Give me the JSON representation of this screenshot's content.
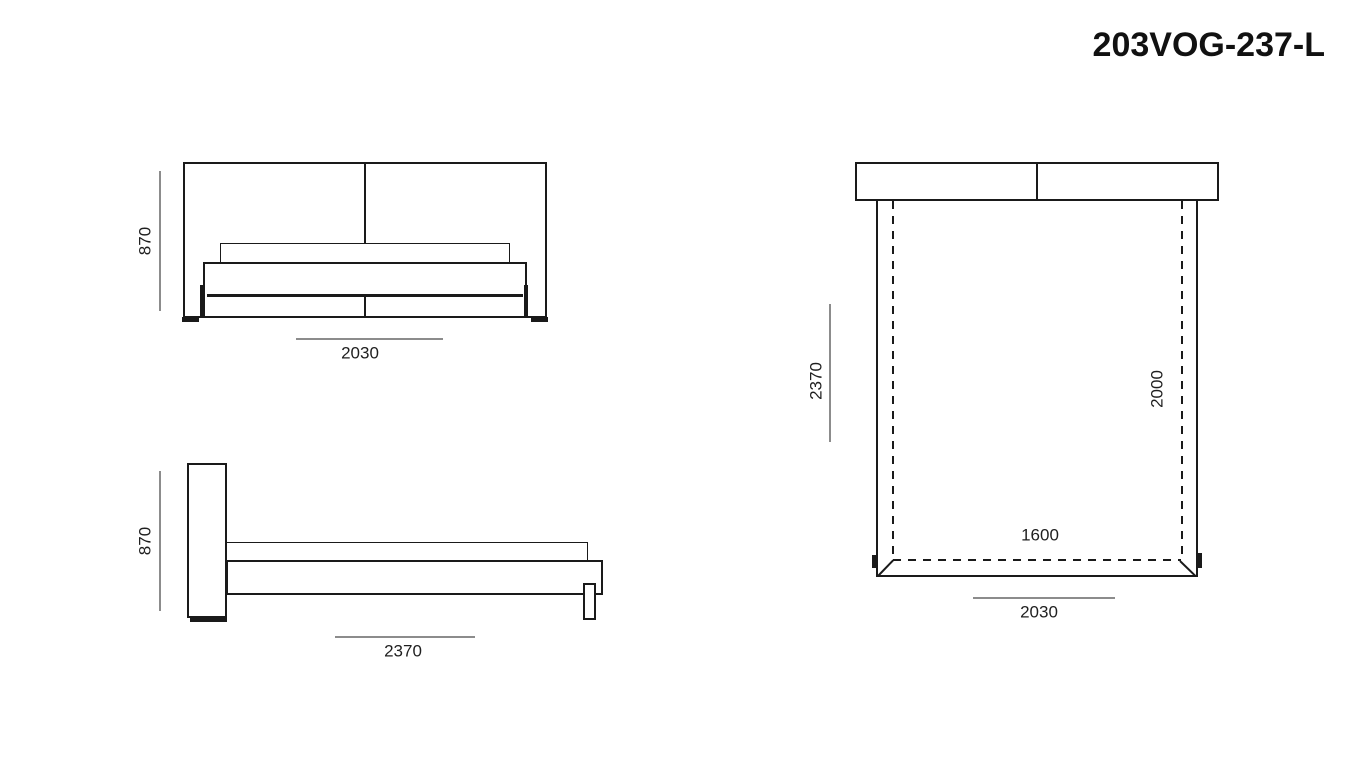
{
  "title": "203VOG-237-L",
  "views": {
    "front": {
      "label": "bed front elevation",
      "dims": {
        "height": "870",
        "width": "2030"
      }
    },
    "side": {
      "label": "bed side elevation",
      "dims": {
        "height": "870",
        "length": "2370"
      }
    },
    "top": {
      "label": "bed plan view",
      "dims": {
        "overall_length": "2370",
        "mattress_length": "2000",
        "mattress_width": "1600",
        "frame_width": "2030"
      }
    }
  },
  "colors": {
    "line": "#1a1a1a",
    "dim": "#8c8c8c",
    "text": "#1f1f1f",
    "bg": "#ffffff"
  }
}
